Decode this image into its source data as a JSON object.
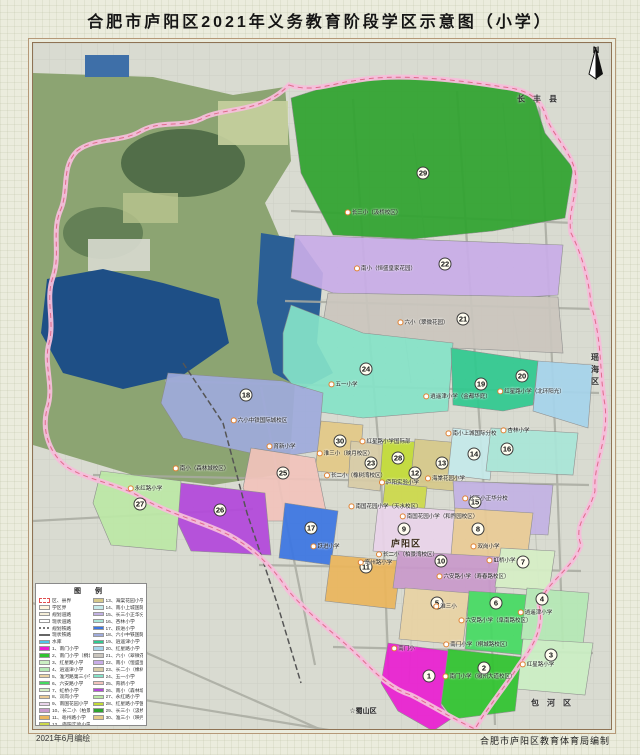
{
  "page": {
    "title": "合肥市庐阳区2021年义务教育阶段学区示意图（小学）",
    "footer_left": "2021年6月编绘",
    "footer_right": "合肥市庐阳区教育体育局编制"
  },
  "compass": {
    "label": "N"
  },
  "legend": {
    "title": "图  例",
    "line_items": [
      {
        "label": "区、县界",
        "swatch": "boundary"
      },
      {
        "label": "学区界",
        "swatch": "xuequ"
      },
      {
        "label": "规划道路",
        "swatch": "road-plan"
      },
      {
        "label": "现状道路",
        "swatch": "road-now"
      },
      {
        "label": "规划铁路",
        "swatch": "rail-plan"
      },
      {
        "label": "现状铁路",
        "swatch": "rail-now"
      },
      {
        "label": "水库",
        "swatch": "water"
      }
    ],
    "schools": [
      {
        "num": 1,
        "name": "南门小学",
        "color": "#EA1FD1"
      },
      {
        "num": 2,
        "name": "南门小学（桐城路校区）",
        "color": "#2FC42F"
      },
      {
        "num": 3,
        "name": "红星路小学",
        "color": "#CBEFC4"
      },
      {
        "num": 4,
        "name": "逍遥津小学",
        "color": "#B5E9B5"
      },
      {
        "num": 5,
        "name": "淮河路第三小学",
        "color": "#E9D3A4"
      },
      {
        "num": 6,
        "name": "六安路小学",
        "color": "#45DA62"
      },
      {
        "num": 7,
        "name": "虹桥小学",
        "color": "#D6EFC6"
      },
      {
        "num": 8,
        "name": "双岗小学",
        "color": "#EACB96"
      },
      {
        "num": 9,
        "name": "南国花园小学",
        "color": "#EAD4EA"
      },
      {
        "num": 10,
        "name": "长二小（柏景湾校区）",
        "color": "#C999CB"
      },
      {
        "num": 11,
        "name": "亳州路小学",
        "color": "#EBB65C"
      },
      {
        "num": 12,
        "name": "庐阳实验小学",
        "color": "#CDD94A"
      },
      {
        "num": 13,
        "name": "海棠花园小学",
        "color": "#D6C98A"
      },
      {
        "num": 14,
        "name": "南小上城国际分校",
        "color": "#C5EAEA"
      },
      {
        "num": 15,
        "name": "长三小正华分校",
        "color": "#C3B2E4"
      },
      {
        "num": 16,
        "name": "杏林小学",
        "color": "#A9E6D8"
      },
      {
        "num": 17,
        "name": "跃进小学",
        "color": "#3B76E3"
      },
      {
        "num": 18,
        "name": "六小中铁国际城校区",
        "color": "#9FABDC"
      },
      {
        "num": 19,
        "name": "逍遥津小学（金都华庭）",
        "color": "#2FC98F"
      },
      {
        "num": 20,
        "name": "红星路小学（北环阳光）",
        "color": "#A6D4EC"
      },
      {
        "num": 21,
        "name": "六小（翠微花园）",
        "color": "#CBC6BE"
      },
      {
        "num": 22,
        "name": "南小（恒盛皇家花园）",
        "color": "#C9ADE8"
      },
      {
        "num": 23,
        "name": "长二小（橡树湾校区）",
        "color": "#D8CCA6"
      },
      {
        "num": 24,
        "name": "五一小学",
        "color": "#86E3C8"
      },
      {
        "num": 25,
        "name": "育新小学",
        "color": "#F2C4BC"
      },
      {
        "num": 26,
        "name": "南小（森林城校区）",
        "color": "#B347DB"
      },
      {
        "num": 27,
        "name": "永红路小学",
        "color": "#BCE9A6"
      },
      {
        "num": 28,
        "name": "红星路小学国际部",
        "color": "#C3DC36"
      },
      {
        "num": 29,
        "name": "长三小（汲桥校区）",
        "color": "#2FA32F"
      },
      {
        "num": 30,
        "name": "淮三小（映月校区）",
        "color": "#E3C987"
      }
    ]
  },
  "map": {
    "district_label": {
      "text": "庐阳区",
      "x": 373,
      "y": 500
    },
    "neighbors": [
      {
        "name": "长丰县",
        "x": 508,
        "y": 56,
        "mode": "h"
      },
      {
        "name": "瑶海区",
        "x": 562,
        "y": 310,
        "mode": "v"
      },
      {
        "name": "包河区",
        "x": 522,
        "y": 660,
        "mode": "h"
      },
      {
        "name": "☆蜀山区",
        "x": 330,
        "y": 668,
        "mode": "plain"
      }
    ],
    "zones": [
      {
        "num": 1,
        "cx": 396,
        "cy": 633
      },
      {
        "num": 2,
        "cx": 451,
        "cy": 625
      },
      {
        "num": 3,
        "cx": 518,
        "cy": 612
      },
      {
        "num": 4,
        "cx": 509,
        "cy": 556
      },
      {
        "num": 5,
        "cx": 404,
        "cy": 560
      },
      {
        "num": 6,
        "cx": 463,
        "cy": 560
      },
      {
        "num": 7,
        "cx": 490,
        "cy": 519
      },
      {
        "num": 8,
        "cx": 445,
        "cy": 486
      },
      {
        "num": 9,
        "cx": 371,
        "cy": 486
      },
      {
        "num": 10,
        "cx": 408,
        "cy": 518
      },
      {
        "num": 11,
        "cx": 333,
        "cy": 524
      },
      {
        "num": 12,
        "cx": 382,
        "cy": 430
      },
      {
        "num": 13,
        "cx": 409,
        "cy": 420
      },
      {
        "num": 14,
        "cx": 441,
        "cy": 411
      },
      {
        "num": 15,
        "cx": 442,
        "cy": 459
      },
      {
        "num": 16,
        "cx": 474,
        "cy": 406
      },
      {
        "num": 17,
        "cx": 278,
        "cy": 485
      },
      {
        "num": 18,
        "cx": 213,
        "cy": 352
      },
      {
        "num": 19,
        "cx": 448,
        "cy": 341
      },
      {
        "num": 20,
        "cx": 489,
        "cy": 333
      },
      {
        "num": 21,
        "cx": 430,
        "cy": 276
      },
      {
        "num": 22,
        "cx": 412,
        "cy": 221
      },
      {
        "num": 23,
        "cx": 338,
        "cy": 420
      },
      {
        "num": 24,
        "cx": 333,
        "cy": 326
      },
      {
        "num": 25,
        "cx": 250,
        "cy": 430
      },
      {
        "num": 26,
        "cx": 187,
        "cy": 467
      },
      {
        "num": 27,
        "cx": 107,
        "cy": 461
      },
      {
        "num": 28,
        "cx": 365,
        "cy": 415
      },
      {
        "num": 29,
        "cx": 390,
        "cy": 130
      },
      {
        "num": 30,
        "cx": 307,
        "cy": 398
      }
    ],
    "labels": [
      {
        "t": "长三小（汲桥校区）",
        "x": 340,
        "y": 170
      },
      {
        "t": "南小（恒盛皇家花园）",
        "x": 352,
        "y": 226
      },
      {
        "t": "六小（翠微花园）",
        "x": 390,
        "y": 280
      },
      {
        "t": "五一小学",
        "x": 310,
        "y": 342
      },
      {
        "t": "六小中铁国际城校区",
        "x": 226,
        "y": 378
      },
      {
        "t": "逍遥津小学（金都华庭）",
        "x": 424,
        "y": 354
      },
      {
        "t": "红星路小学（北环阳光）",
        "x": 498,
        "y": 349
      },
      {
        "t": "南小上城国际分校",
        "x": 438,
        "y": 391
      },
      {
        "t": "杏林小学",
        "x": 482,
        "y": 388
      },
      {
        "t": "红星路小学国际部",
        "x": 352,
        "y": 399
      },
      {
        "t": "淮三小（映月校区）",
        "x": 312,
        "y": 411
      },
      {
        "t": "长三小正华分校",
        "x": 452,
        "y": 456
      },
      {
        "t": "庐阳实验小学",
        "x": 366,
        "y": 440
      },
      {
        "t": "海棠花园小学",
        "x": 412,
        "y": 436
      },
      {
        "t": "长二小（橡树湾校区）",
        "x": 322,
        "y": 433
      },
      {
        "t": "育新小学",
        "x": 248,
        "y": 404
      },
      {
        "t": "南小（森林城校区）",
        "x": 168,
        "y": 426
      },
      {
        "t": "永红路小学",
        "x": 112,
        "y": 446
      },
      {
        "t": "南国花园小学（天水校区）",
        "x": 352,
        "y": 464
      },
      {
        "t": "南国花园小学（和煦园校区）",
        "x": 406,
        "y": 474
      },
      {
        "t": "双岗小学",
        "x": 452,
        "y": 504
      },
      {
        "t": "跃进小学",
        "x": 292,
        "y": 504
      },
      {
        "t": "亳州路小学",
        "x": 342,
        "y": 520
      },
      {
        "t": "长二小（柏景湾校区）",
        "x": 374,
        "y": 512
      },
      {
        "t": "虹桥小学",
        "x": 468,
        "y": 518
      },
      {
        "t": "六安路小学（寿春路校区）",
        "x": 440,
        "y": 534
      },
      {
        "t": "淮三小",
        "x": 412,
        "y": 564
      },
      {
        "t": "六安路小学（阜南路校区）",
        "x": 462,
        "y": 578
      },
      {
        "t": "逍遥津小学",
        "x": 502,
        "y": 570
      },
      {
        "t": "红星路小学",
        "x": 504,
        "y": 622
      },
      {
        "t": "南门小",
        "x": 370,
        "y": 606
      },
      {
        "t": "南门小学（桐城路校区）",
        "x": 444,
        "y": 602
      },
      {
        "t": "南门小学（徽州大道校区）",
        "x": 446,
        "y": 634
      }
    ]
  }
}
